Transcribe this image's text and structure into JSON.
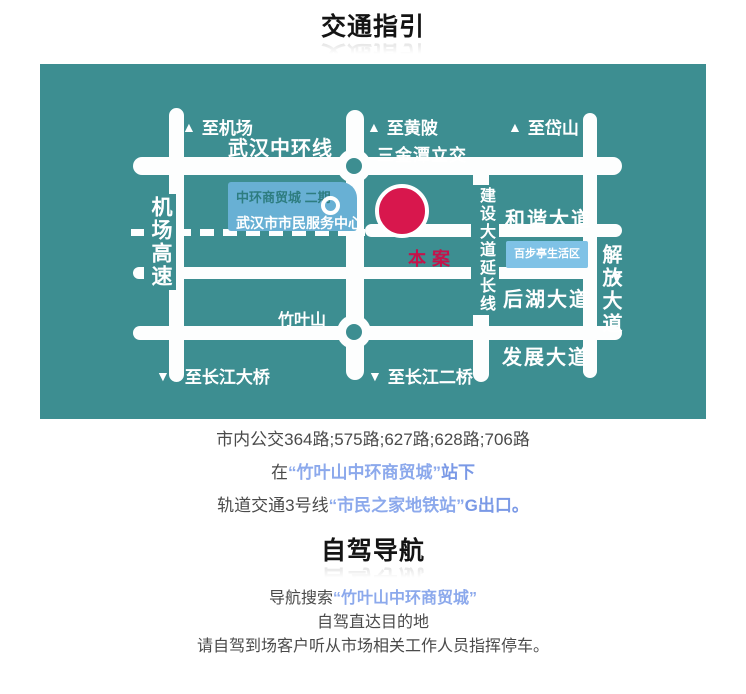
{
  "headings": {
    "transit_title": "交通指引",
    "driving_title": "自驾导航"
  },
  "map": {
    "colors": {
      "background": "#3D8E91",
      "road": "#FDFEFE",
      "marker": "#D8174D",
      "marker_text": "#C4134B",
      "info_box1": "#68B0D4",
      "info_box2": "#7FC2E6"
    },
    "icons": {
      "up_arrow": "▲",
      "down_arrow": "▼",
      "right_arrow": "▶"
    },
    "labels": {
      "to_airport": "至机场",
      "wuhan_ring_road": "武汉中环线",
      "to_huangpi": "至黄陂",
      "sanjintan_interchange": "三金潭立交",
      "to_daishan": "至岱山",
      "airport_expressway": "机场高速",
      "mall_phase2": "中环商贸城 二期",
      "citizen_center": "武汉市市民服务中心",
      "project_site": "本案",
      "jianshe_ext": "建设大道延长线",
      "hexie_avenue": "和谐大道",
      "baibuting_area": "百步亭生活区",
      "jiefang_avenue": "解放大道",
      "houhu_avenue": "后湖大道",
      "zhuyeshan": "竹叶山",
      "fazhan_avenue": "发展大道",
      "to_changjiang_bridge": "至长江大桥",
      "to_changjiang_bridge2": "至长江二桥"
    }
  },
  "transit": {
    "bus_line": "市内公交364路;575路;627路;628路;706路",
    "stop_prefix": "在",
    "stop_name": "“竹叶山中环商贸城”",
    "stop_suffix": "站下",
    "metro_prefix": "轨道交通3号线",
    "metro_station": "“市民之家地铁站”",
    "metro_suffix": "G出口。"
  },
  "driving": {
    "nav_prefix": "导航搜索",
    "nav_keyword": "“竹叶山中环商贸城”",
    "line2": "自驾直达目的地",
    "line3": "请自驾到场客户听从市场相关工作人员指挥停车。"
  }
}
